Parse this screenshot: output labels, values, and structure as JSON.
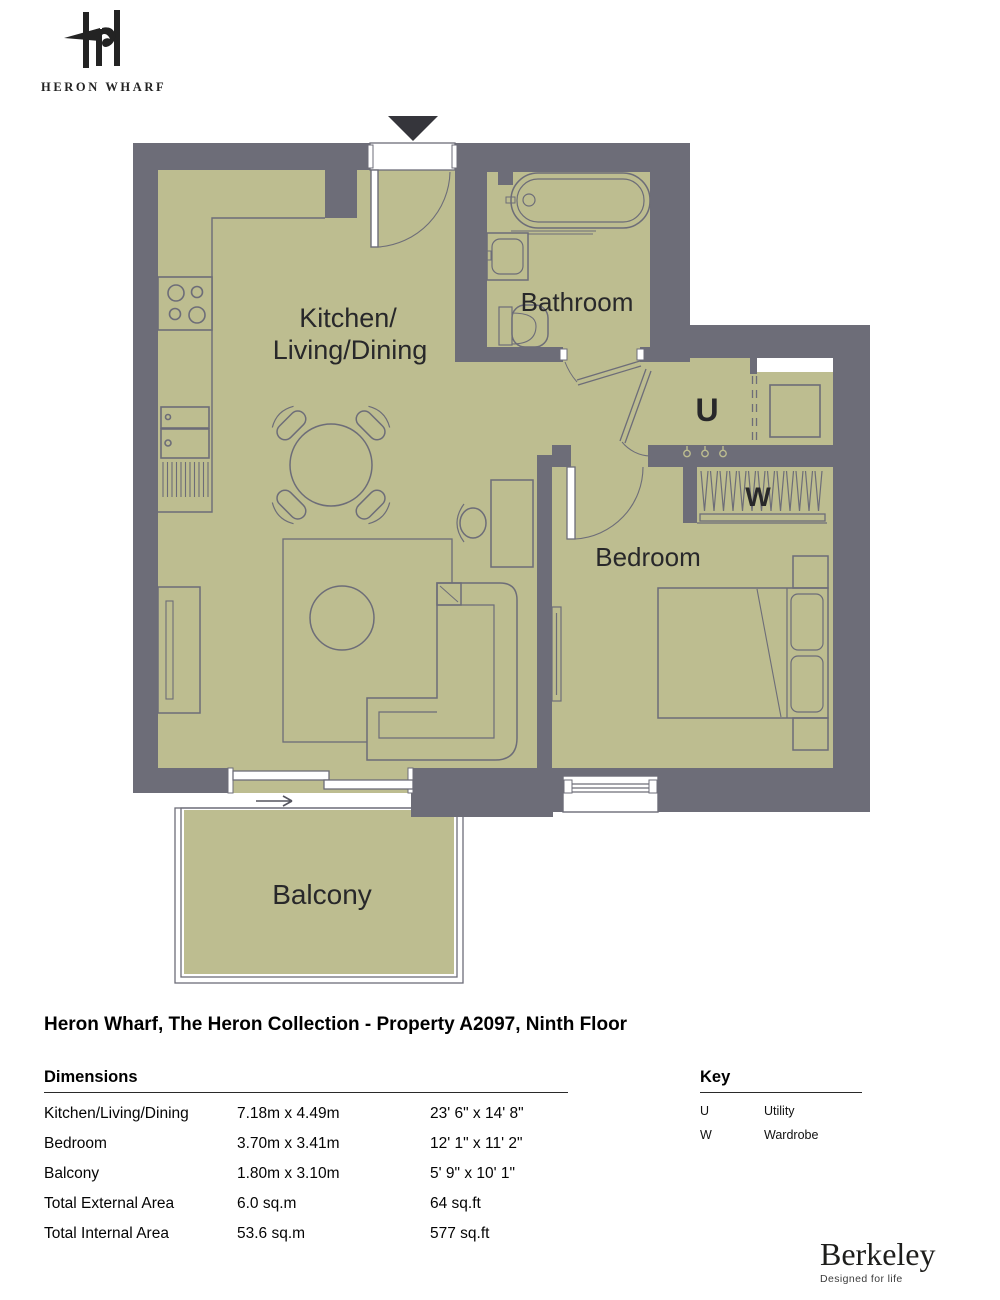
{
  "logo": {
    "wordmark": "HERON WHARF"
  },
  "plan": {
    "rooms": {
      "kitchen_line1": "Kitchen/",
      "kitchen_line2": "Living/Dining",
      "bathroom": "Bathroom",
      "bedroom": "Bedroom",
      "balcony": "Balcony",
      "utility_abbr": "U",
      "wardrobe_abbr": "W"
    },
    "colors": {
      "wall": "#6d6d78",
      "floor": "#bdbd90",
      "entrance_marker": "#35353b"
    }
  },
  "title": "Heron Wharf, The Heron Collection - Property A2097, Ninth Floor",
  "dimensions": {
    "heading": "Dimensions",
    "rows": [
      {
        "label": "Kitchen/Living/Dining",
        "metric": "7.18m x 4.49m",
        "imperial": "23' 6\" x 14' 8\""
      },
      {
        "label": "Bedroom",
        "metric": "3.70m x 3.41m",
        "imperial": "12' 1\" x 11' 2\""
      },
      {
        "label": "Balcony",
        "metric": "1.80m x 3.10m",
        "imperial": "5' 9\" x 10' 1\""
      },
      {
        "label": "Total External Area",
        "metric": "6.0 sq.m",
        "imperial": "64 sq.ft"
      },
      {
        "label": "Total Internal Area",
        "metric": "53.6 sq.m",
        "imperial": "577 sq.ft"
      }
    ]
  },
  "key": {
    "heading": "Key",
    "entries": [
      {
        "abbr": "U",
        "label": "Utility"
      },
      {
        "abbr": "W",
        "label": "Wardrobe"
      }
    ]
  },
  "brand": {
    "name": "Berkeley",
    "tagline": "Designed for life"
  }
}
